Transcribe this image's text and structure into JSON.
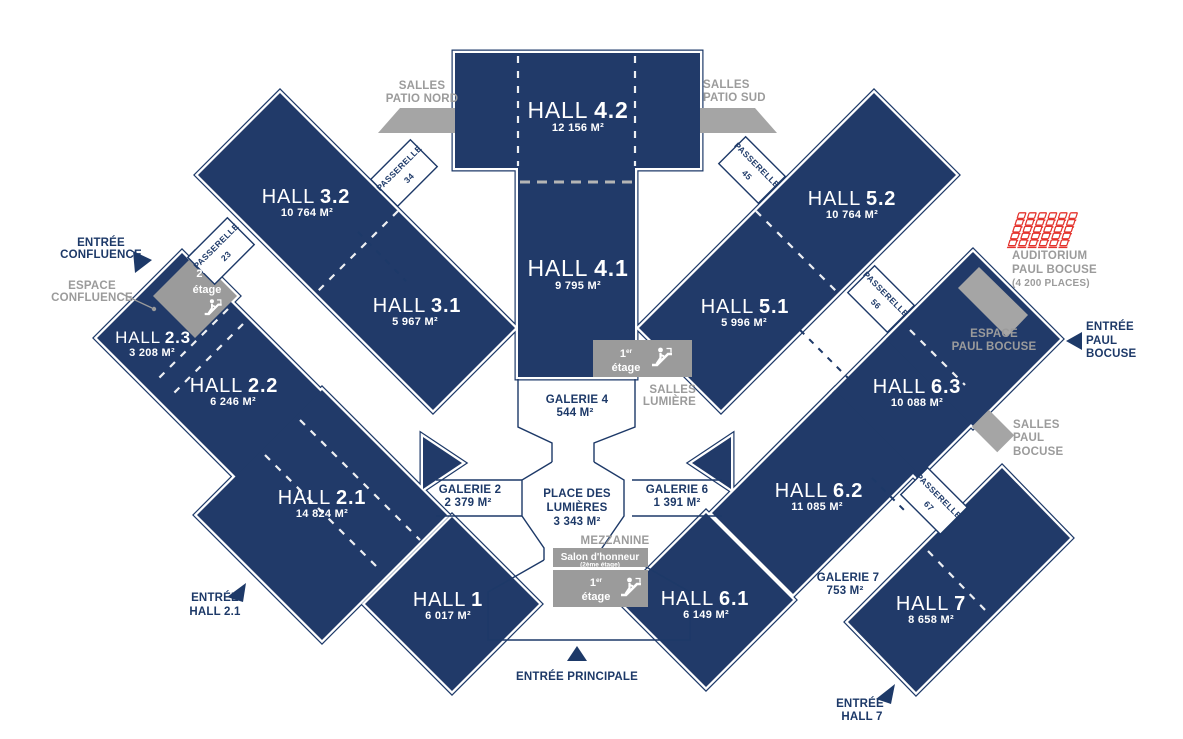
{
  "title": "Exhibition center floor plan",
  "palette": {
    "navy_fill": "#213a69",
    "navy_outline": "#1d3968",
    "label_navy": "#1d3968",
    "gray": "#9b9b9b",
    "gray_shape": "#a5a5a5",
    "seat_red": "#e4332d",
    "dash_gray": "#b5b5b5"
  },
  "halls": {
    "h42": {
      "name": "HALL",
      "num": "4.2",
      "area": "12 156 M²"
    },
    "h41": {
      "name": "HALL",
      "num": "4.1",
      "area": "9 795 M²"
    },
    "h32": {
      "name": "HALL",
      "num": "3.2",
      "area": "10 764 M²"
    },
    "h31": {
      "name": "HALL",
      "num": "3.1",
      "area": "5 967 M²"
    },
    "h23": {
      "name": "HALL",
      "num": "2.3",
      "area": "3 208 M²"
    },
    "h22": {
      "name": "HALL",
      "num": "2.2",
      "area": "6 246 M²"
    },
    "h21": {
      "name": "HALL",
      "num": "2.1",
      "area": "14 824 M²"
    },
    "h1": {
      "name": "HALL",
      "num": "1",
      "area": "6 017 M²"
    },
    "h52": {
      "name": "HALL",
      "num": "5.2",
      "area": "10 764 M²"
    },
    "h51": {
      "name": "HALL",
      "num": "5.1",
      "area": "5 996 M²"
    },
    "h63": {
      "name": "HALL",
      "num": "6.3",
      "area": "10 088 M²"
    },
    "h62": {
      "name": "HALL",
      "num": "6.2",
      "area": "11 085 M²"
    },
    "h61": {
      "name": "HALL",
      "num": "6.1",
      "area": "6 149 M²"
    },
    "h7": {
      "name": "HALL",
      "num": "7",
      "area": "8 658 M²"
    }
  },
  "galleries": {
    "g2": {
      "name": "GALERIE 2",
      "area": "2 379 M²"
    },
    "g4": {
      "name": "GALERIE 4",
      "area": "544 M²"
    },
    "g6": {
      "name": "GALERIE 6",
      "area": "1 391 M²"
    },
    "g7": {
      "name": "GALERIE 7",
      "area": "753 M²"
    }
  },
  "place": {
    "line1": "PLACE DES",
    "line2": "LUMIÈRES",
    "area": "3 343 M²"
  },
  "mezzanine": {
    "label": "MEZZANINE",
    "salon": "Salon d'honneur",
    "salon_floor": "(2ème étage)"
  },
  "floors": {
    "first_num": "1",
    "first_sup": "er",
    "second_num": "2",
    "second_sup": "ème",
    "etage": "étage"
  },
  "passerelles": {
    "p23": {
      "name": "PASSERELLE",
      "num": "23"
    },
    "p34": {
      "name": "PASSERELLE",
      "num": "34"
    },
    "p45": {
      "name": "PASSERELLE",
      "num": "45"
    },
    "p56": {
      "name": "PASSERELLE",
      "num": "56"
    },
    "p67": {
      "name": "PASSERELLE",
      "num": "67"
    }
  },
  "entrances": {
    "confluence": {
      "line1": "ENTRÉE",
      "line2": "CONFLUENCE"
    },
    "hall21": {
      "line1": "ENTRÉE",
      "line2": "HALL 2.1"
    },
    "principale": {
      "line1": "ENTRÉE PRINCIPALE"
    },
    "hall7": {
      "line1": "ENTRÉE",
      "line2": "HALL 7"
    },
    "paul_bocuse": {
      "line1": "ENTRÉE",
      "line2": "PAUL",
      "line3": "BOCUSE"
    }
  },
  "areas_gray": {
    "patio_nord": {
      "line1": "SALLES",
      "line2": "PATIO NORD"
    },
    "patio_sud": {
      "line1": "SALLES",
      "line2": "PATIO SUD"
    },
    "espace_confluence": {
      "line1": "ESPACE",
      "line2": "CONFLUENCE"
    },
    "salles_lumiere": {
      "line1": "SALLES",
      "line2": "LUMIÈRE"
    },
    "auditorium": {
      "line1": "AUDITORIUM",
      "line2": "PAUL BOCUSE",
      "line3": "(4 200 PLACES)"
    },
    "espace_paul_bocuse": {
      "line1": "ESPACE",
      "line2": "PAUL BOCUSE"
    },
    "salles_paul_bocuse": {
      "line1": "SALLES",
      "line2": "PAUL",
      "line3": "BOCUSE"
    }
  }
}
